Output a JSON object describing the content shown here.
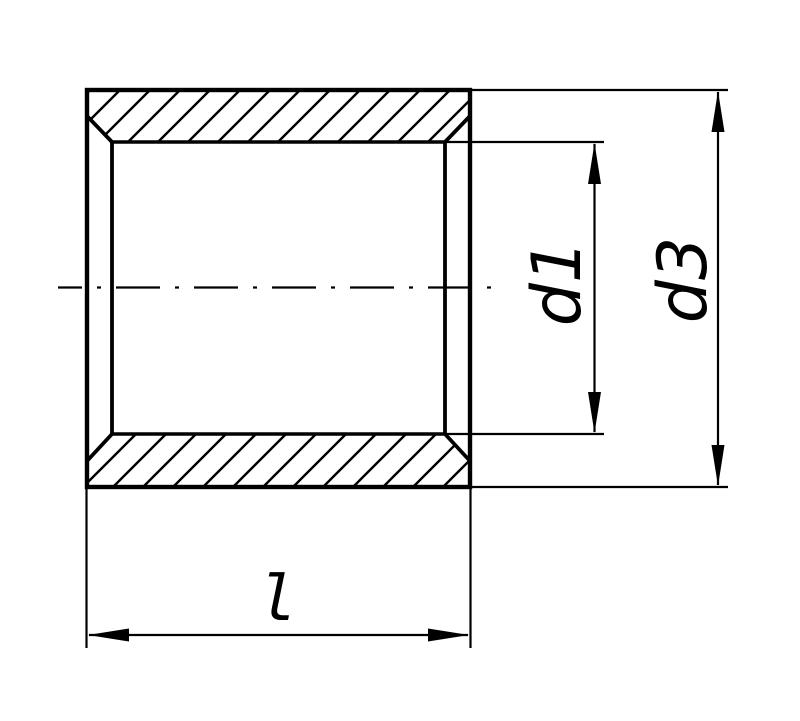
{
  "drawing": {
    "background_color": "#ffffff",
    "line_color": "#000000",
    "view": "section",
    "dimensions": {
      "inner_diameter": {
        "label": "d1"
      },
      "outer_diameter": {
        "label": "d3"
      },
      "length": {
        "label": "l"
      }
    }
  }
}
